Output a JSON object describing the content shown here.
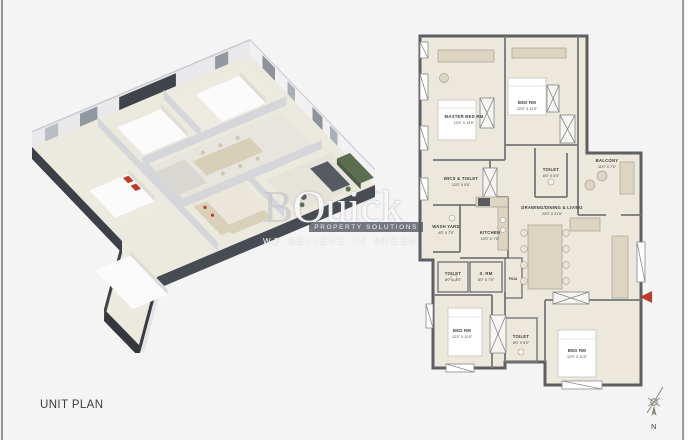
{
  "page": {
    "title": "UNIT PLAN"
  },
  "watermark": {
    "brand_b": "B",
    "brand_rest": "Quick",
    "badge": "PROPERTY SOLUTIONS",
    "tagline": "WE BELIEVE IN SPEED"
  },
  "compass": {
    "north_label": "N"
  },
  "colors": {
    "page_bg": "#f4f4f5",
    "floor_beige": "#ece8dc",
    "wall_gray": "#5f5f63",
    "charcoal_wall": "#3a3e44",
    "accent_red": "#c0392b",
    "hedge_green": "#5c6e50",
    "bed_white": "#fbfbfb",
    "furniture_beige": "#d8cfb8"
  },
  "floorplan": {
    "rooms": [
      {
        "name": "MASTER BED RM",
        "dims": "12'0\" X 13'0\""
      },
      {
        "name": "BED RM",
        "dims": "12'0\" X 11'0\""
      },
      {
        "name": "WICS & TOILET",
        "dims": "12'0\" X 5'0\""
      },
      {
        "name": "TOILET",
        "dims": "8'0\" X 5'0\""
      },
      {
        "name": "BALCONY",
        "dims": "11'0\" X 7'0\""
      },
      {
        "name": "DRAWING/DINING & LIVING",
        "dims": "22'0\" X 21'0\""
      },
      {
        "name": "WASH YARD",
        "dims": "4'0\" X 7'0\""
      },
      {
        "name": "KITCHEN",
        "dims": "12'0\" X 7'0\""
      },
      {
        "name": "TOILET",
        "dims": "8'0\" X 5'0\""
      },
      {
        "name": "S. RM",
        "dims": "8'0\" X 7'0\""
      },
      {
        "name": "PUJA",
        "dims": ""
      },
      {
        "name": "BED RM",
        "dims": "12'0\" X 11'0\""
      },
      {
        "name": "TOILET",
        "dims": "8'0\" X 5'0\""
      },
      {
        "name": "BED RM",
        "dims": "12'0\" X 11'0\""
      }
    ]
  }
}
